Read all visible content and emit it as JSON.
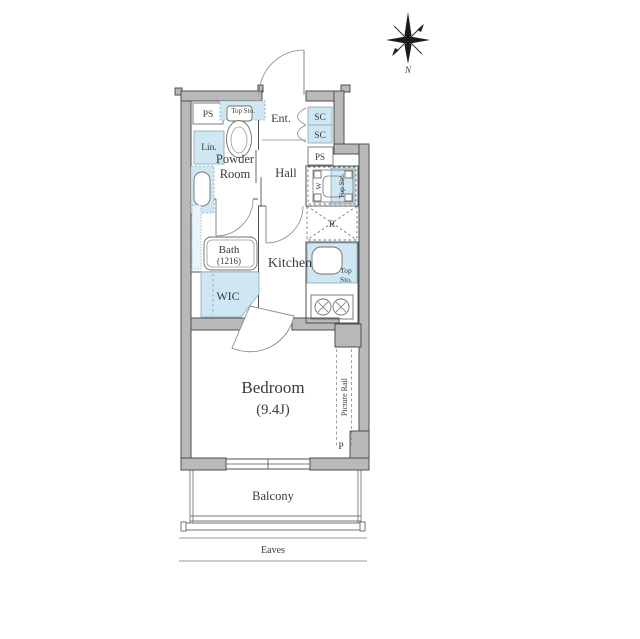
{
  "compass": {
    "north": "N"
  },
  "rooms": {
    "ent": "Ent.",
    "hall": "Hall",
    "powder1": "Powder",
    "powder2": "Room",
    "bath1": "Bath",
    "bath2": "(1216)",
    "kitchen": "Kitchen",
    "wic": "WIC",
    "bedroom1": "Bedroom",
    "bedroom2": "(9.4J)",
    "balcony": "Balcony",
    "eaves": "Eaves"
  },
  "fixtures": {
    "ps_left": "PS",
    "ps_right": "PS",
    "sc_top": "SC",
    "sc_bottom": "SC",
    "lin": "Lin.",
    "top_sto_toilet": "Top Sto.",
    "top_sto_washer": "Top Sto.",
    "top_kitchen_1": "Top",
    "top_kitchen_2": "Sto.",
    "washer": "W",
    "fridge": "R",
    "picture_rail": "Picture Rail",
    "p": "P"
  },
  "colors": {
    "wall": "#b9b9b9",
    "wall_outline": "#4f4f4f",
    "fixture_blue": "#cfe7f3",
    "fixture_blue_border": "#86aabc",
    "line": "#555555",
    "text": "#3b3b3b"
  }
}
